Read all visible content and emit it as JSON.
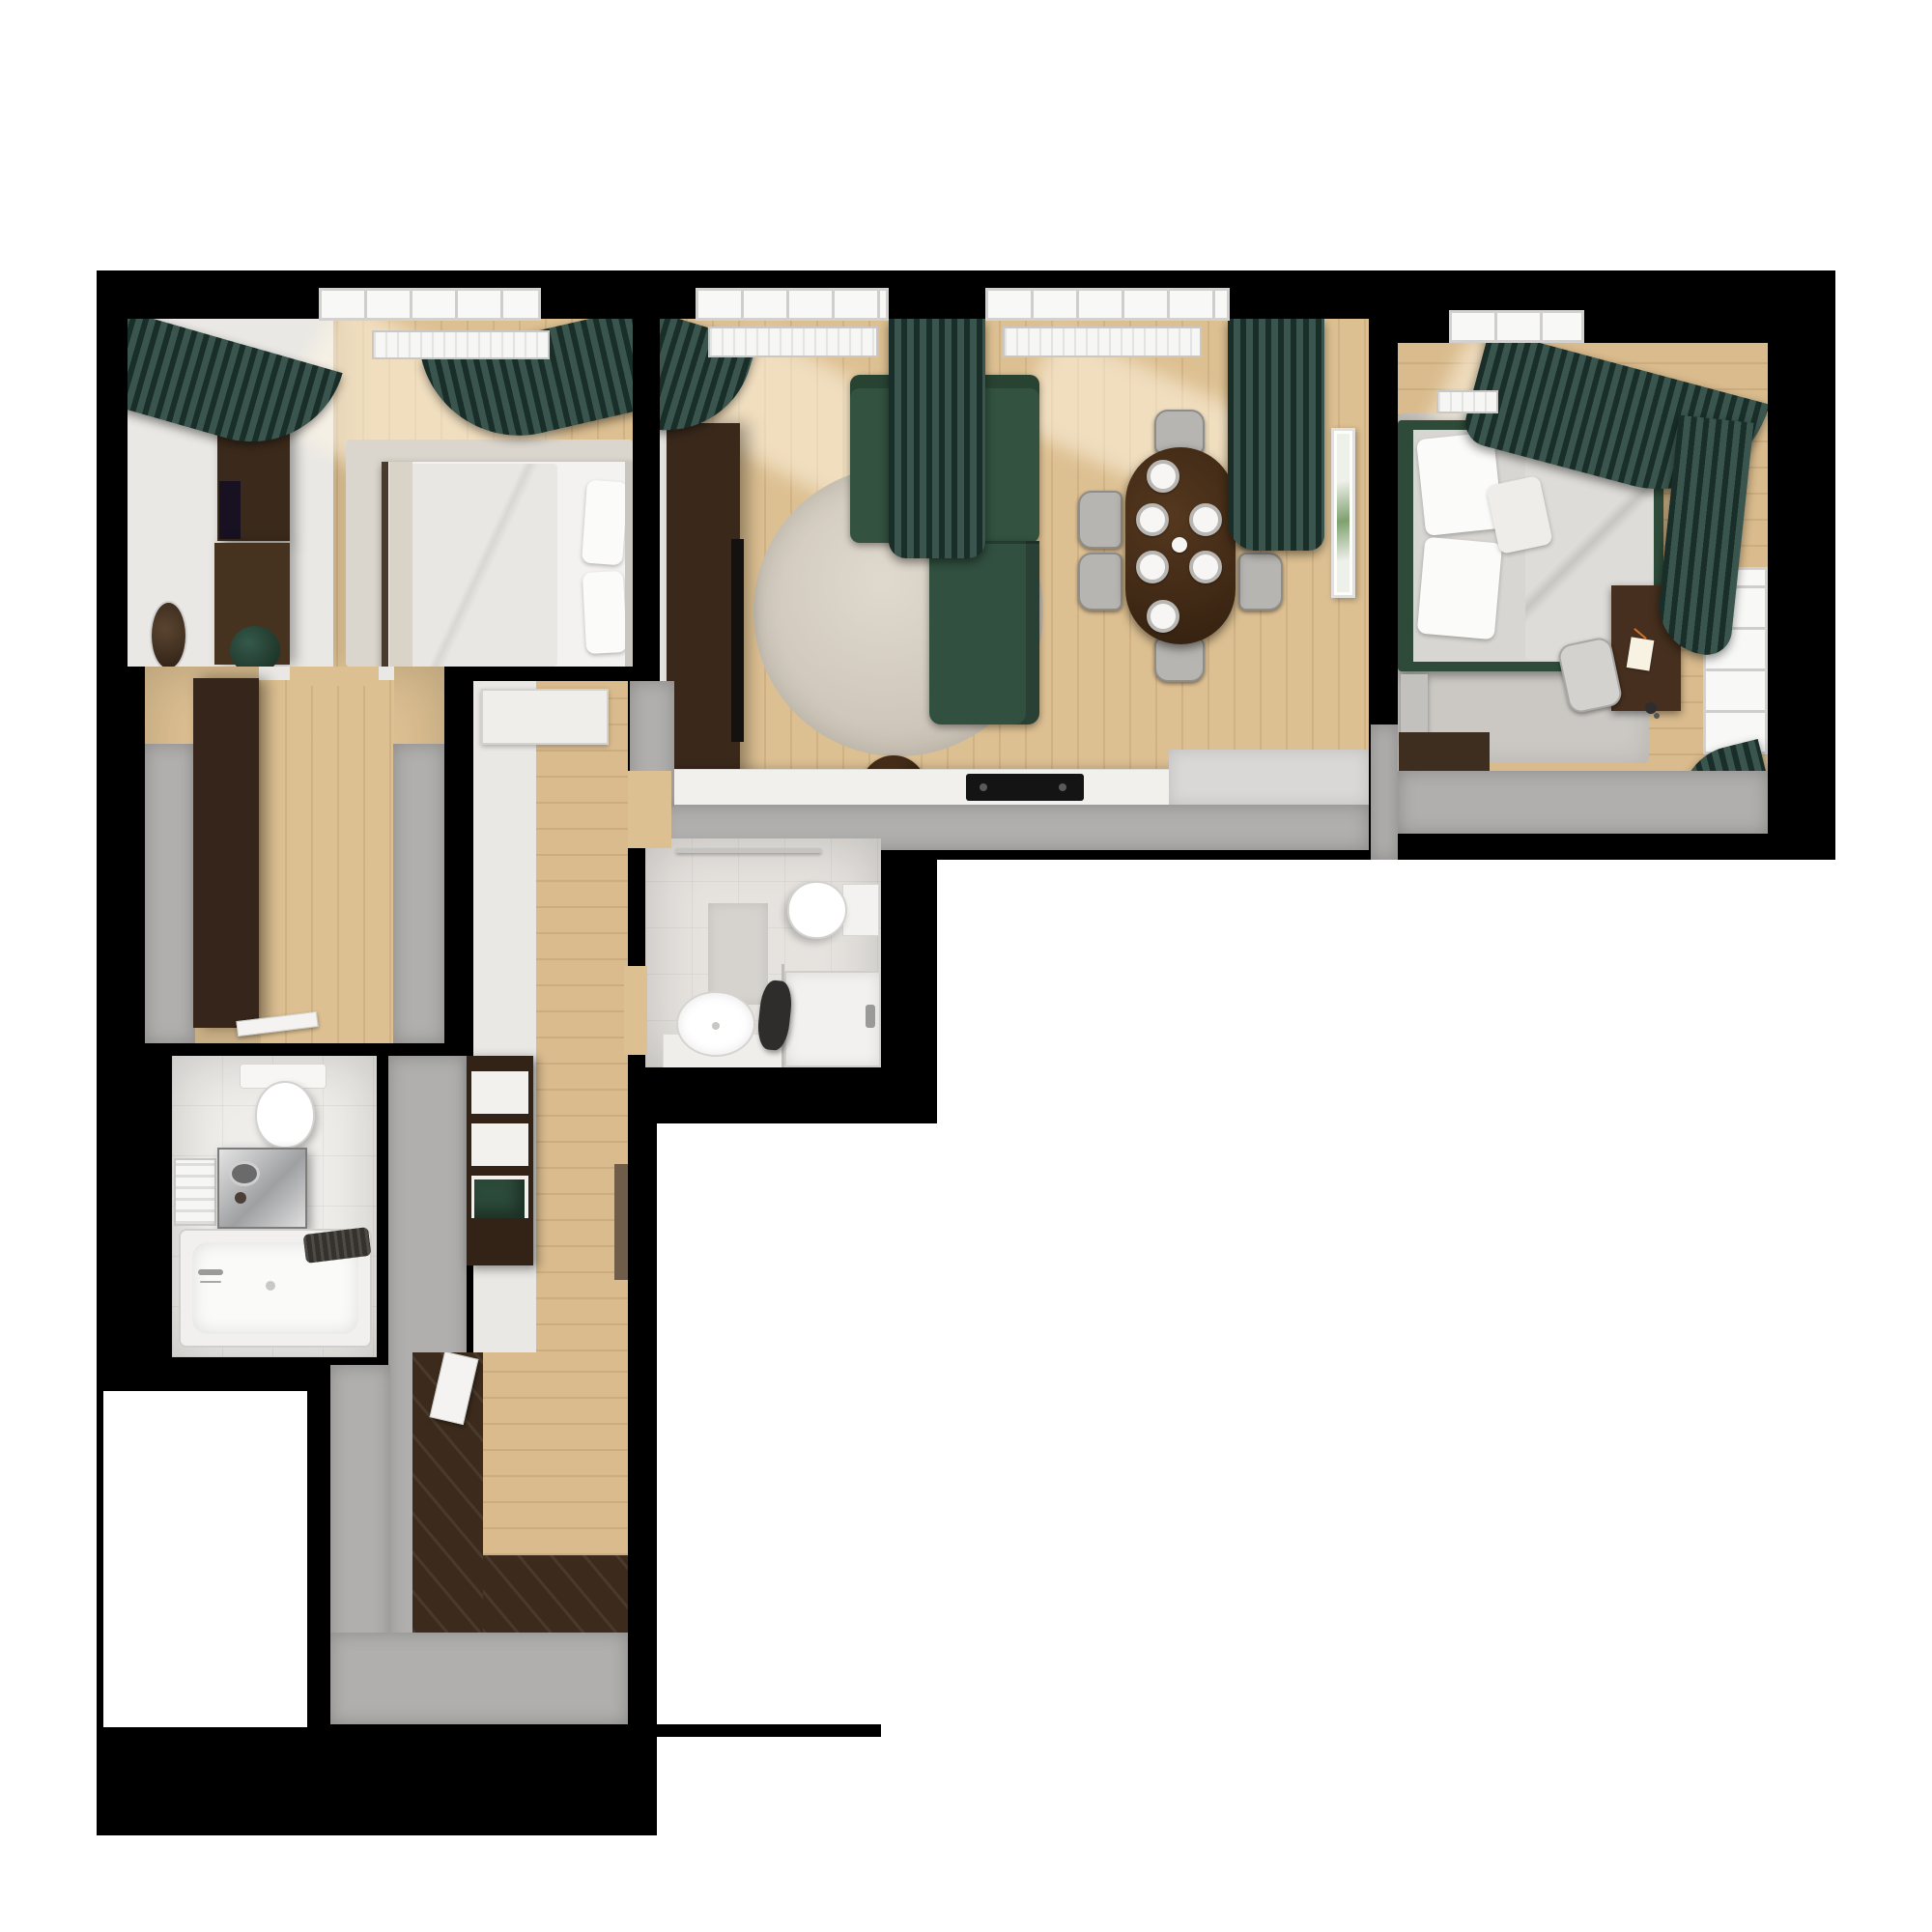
{
  "title": "3D rendered top-down floor plan of an apartment",
  "palette": {
    "canvas_white": "#ffffff",
    "wall_black": "#000000",
    "wall_gray_cap": "#b0afad",
    "wall_white": "#eae8e4",
    "floor_wood_light": "#ddc092",
    "floor_wood_dark_entry": "#3c2b1c",
    "tile_white": "#efedea",
    "curtain_green": "#2c4c3d",
    "sofa_green": "#33523f",
    "bed_frame_green": "#2e4b3a",
    "furniture_dark_brown": "#452f1d",
    "bedding_white": "#f3f2f0",
    "bedding_gray": "#d8d6d2",
    "rug_round_beige": "#cfc7ba",
    "rug_gray": "#cbc8c3"
  },
  "rooms": [
    {
      "id": "bedroom-1",
      "label": "Bedroom 1 (top left)",
      "furniture": [
        "double bed with white bedding and two pillows",
        "area rug",
        "wardrobe with TV panel",
        "dresser",
        "round wall mirror",
        "green pouf",
        "window with radiator",
        "green curtains"
      ]
    },
    {
      "id": "living-dining",
      "label": "Living / dining room (top middle)",
      "furniture": [
        "green L-shaped sofa",
        "round beige rug",
        "round coffee table with open book",
        "dark TV console",
        "oval dining table with six place settings and vase",
        "six gray dining chairs",
        "kitchen counter with black cooktop",
        "framed wall art",
        "two windows with radiators",
        "green curtains"
      ]
    },
    {
      "id": "bedroom-2",
      "label": "Bedroom 2 (top right)",
      "furniture": [
        "green-framed bed with gray bedding and pillows",
        "gray rug",
        "writing desk with notebook, pen and lamp",
        "desk chair",
        "bedside bench",
        "north window with radiator",
        "east window",
        "green curtains"
      ]
    },
    {
      "id": "hallway",
      "label": "Entry hallway (left)",
      "furniture": [
        "built-in dark closet",
        "open door leaf"
      ]
    },
    {
      "id": "corridor",
      "label": "Corridor (center)",
      "furniture": [
        "white bench",
        "open shelving wardrobe with green box",
        "runner mat"
      ]
    },
    {
      "id": "entry",
      "label": "Entry vestibule (bottom)",
      "furniture": [
        "dark wood entry flooring",
        "bathroom door"
      ]
    },
    {
      "id": "bathroom-1",
      "label": "Bathroom with bathtub (bottom left)",
      "furniture": [
        "toilet",
        "washing machine",
        "bathtub with chrome faucet",
        "towel radiator",
        "dark towels"
      ]
    },
    {
      "id": "bathroom-2",
      "label": "Shower bathroom (center)",
      "furniture": [
        "toilet",
        "oval basin on counter",
        "shower enclosure",
        "bath mat",
        "towel rail",
        "hanging dark clothes"
      ]
    }
  ]
}
